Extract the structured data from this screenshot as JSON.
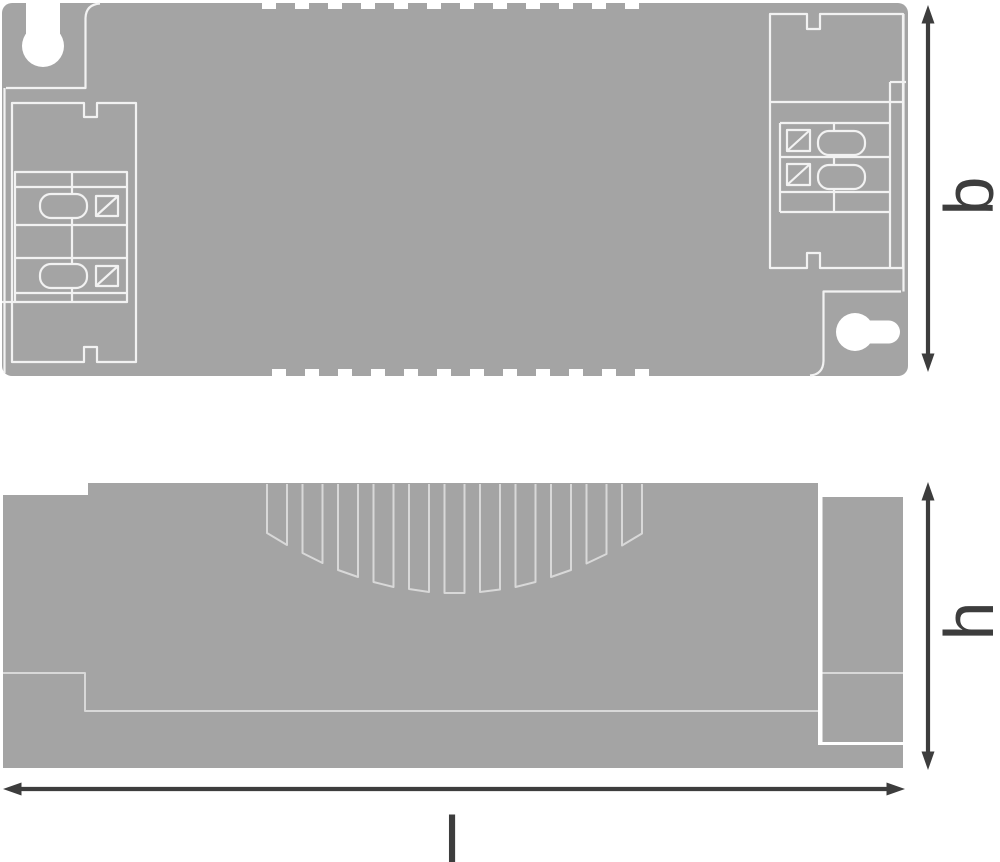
{
  "drawing": {
    "type": "technical-dimension-drawing",
    "dimensions": {
      "width_label": "b",
      "height_label": "h",
      "length_label": "l"
    },
    "colors": {
      "background": "#ffffff",
      "body": "#a4a4a4",
      "line-top": "#f2f2f2",
      "line-side": "#d8d8d8",
      "dimension": "#3d3d3d"
    }
  }
}
